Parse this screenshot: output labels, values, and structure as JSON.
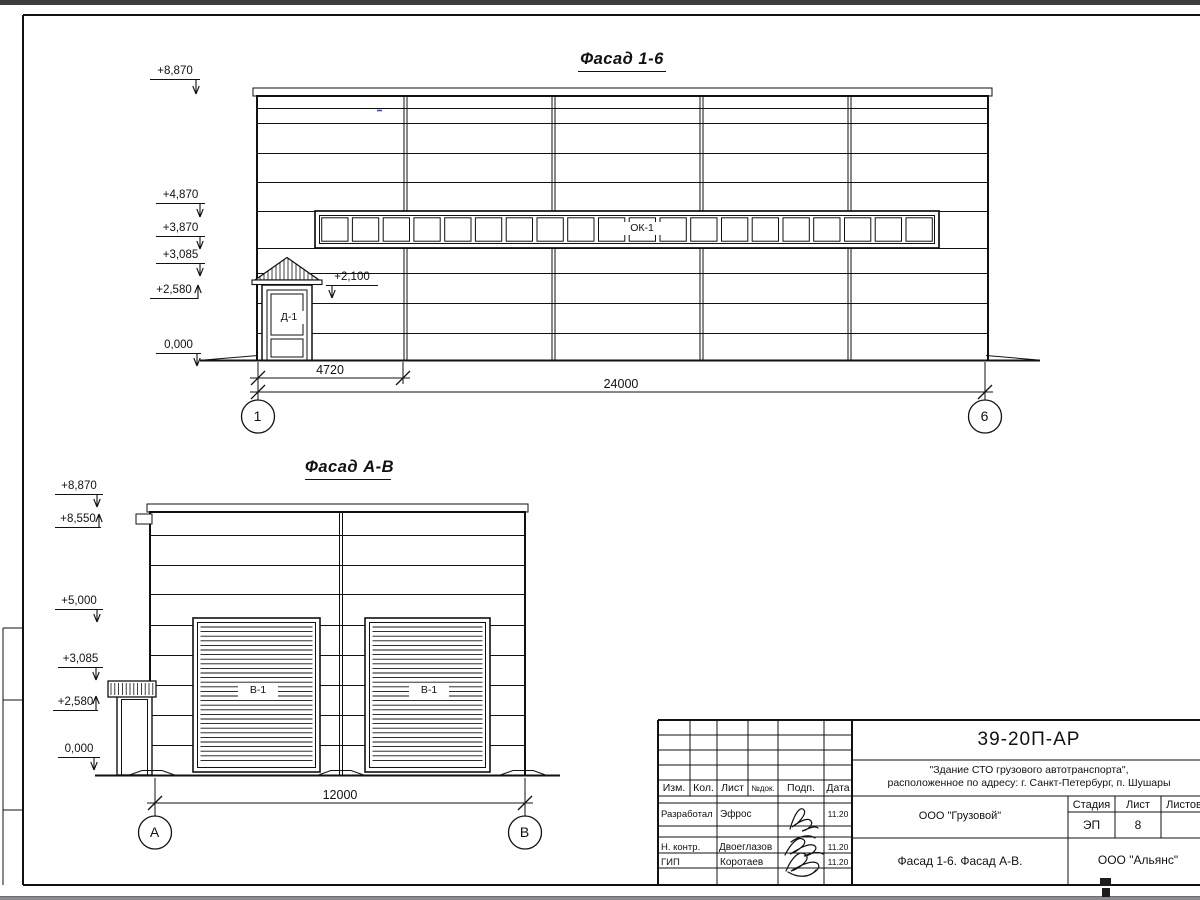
{
  "facade16": {
    "title": "Фасад 1-6",
    "elevations": [
      {
        "label": "+8,870"
      },
      {
        "label": "+4,870"
      },
      {
        "label": "+3,870"
      },
      {
        "label": "+3,085"
      },
      {
        "label": "+2,580"
      },
      {
        "label": "0,000"
      }
    ],
    "door_mark": {
      "label": "+2,100"
    },
    "window_tag": "ОК-1",
    "door_tag": "Д-1",
    "dims": {
      "bay": "4720",
      "total": "24000"
    },
    "axes": {
      "left": "1",
      "right": "6"
    }
  },
  "facadeAB": {
    "title": "Фасад А-В",
    "elevations": [
      {
        "label": "+8,870"
      },
      {
        "label": "+8,550"
      },
      {
        "label": "+5,000"
      },
      {
        "label": "+3,085"
      },
      {
        "label": "+2,580"
      },
      {
        "label": "0,000"
      }
    ],
    "gate_tag": "В-1",
    "dims": {
      "total": "12000"
    },
    "axes": {
      "left": "А",
      "right": "В"
    }
  },
  "titleblock": {
    "doc_number": "39-20П-АР",
    "project_name_line1": "\"Здание СТО грузового автотранспорта\",",
    "project_name_line2": "расположенное по адресу: г. Санкт-Петербург, п. Шушары",
    "client": "ООО \"Грузовой\"",
    "drawing_title": "Фасад 1-6. Фасад А-В.",
    "organization": "ООО \"Альянс\"",
    "stage": {
      "label": "Стадия",
      "value": "ЭП"
    },
    "sheet": {
      "label": "Лист",
      "value": "8"
    },
    "sheets": {
      "label": "Листов",
      "value": ""
    },
    "columns": {
      "izm": "Изм.",
      "kol": "Кол.",
      "list": "Лист",
      "ndok": "№док.",
      "podp": "Подп.",
      "data": "Дата"
    },
    "signatures": [
      {
        "role": "Разработал",
        "name": "Эфрос",
        "date": "11.20"
      },
      {
        "role": "Н. контр.",
        "name": "Двоеглазов",
        "date": "11.20"
      },
      {
        "role": "ГИП",
        "name": "Коротаев",
        "date": "11.20"
      }
    ]
  }
}
